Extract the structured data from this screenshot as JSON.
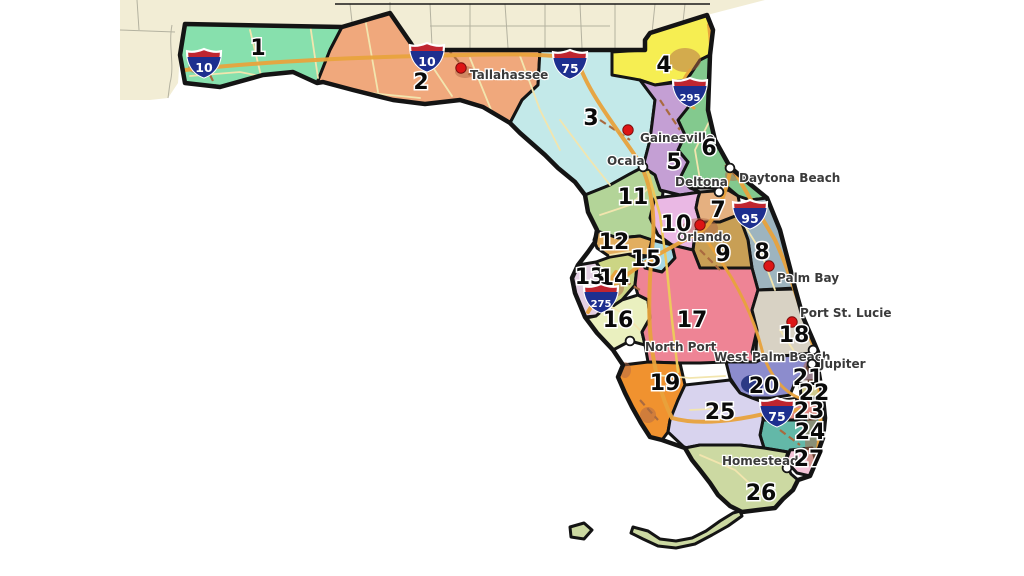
{
  "map": {
    "districts": [
      {
        "number": "1",
        "color": "#87e0ad",
        "label_x": 258,
        "label_y": 55
      },
      {
        "number": "2",
        "color": "#f0a87c",
        "label_x": 421,
        "label_y": 89
      },
      {
        "number": "3",
        "color": "#c3e9e9",
        "label_x": 591,
        "label_y": 125
      },
      {
        "number": "4",
        "color": "#f6ee52",
        "label_x": 664,
        "label_y": 72
      },
      {
        "number": "5",
        "color": "#c49fd4",
        "label_x": 674,
        "label_y": 169
      },
      {
        "number": "6",
        "color": "#83c98e",
        "label_x": 709,
        "label_y": 155
      },
      {
        "number": "7",
        "color": "#e5b080",
        "label_x": 718,
        "label_y": 217
      },
      {
        "number": "8",
        "color": "#9db4bf",
        "label_x": 762,
        "label_y": 259
      },
      {
        "number": "9",
        "color": "#c89f55",
        "label_x": 723,
        "label_y": 261
      },
      {
        "number": "10",
        "color": "#eab8e4",
        "label_x": 676,
        "label_y": 231
      },
      {
        "number": "11",
        "color": "#b3d498",
        "label_x": 633,
        "label_y": 204
      },
      {
        "number": "12",
        "color": "#e2ae5f",
        "label_x": 614,
        "label_y": 249
      },
      {
        "number": "13",
        "color": "#e3cfe3",
        "label_x": 590,
        "label_y": 284
      },
      {
        "number": "14",
        "color": "#ccd584",
        "label_x": 614,
        "label_y": 285
      },
      {
        "number": "15",
        "color": "#a7d8e3",
        "label_x": 646,
        "label_y": 266
      },
      {
        "number": "16",
        "color": "#eaf0bf",
        "label_x": 618,
        "label_y": 327
      },
      {
        "number": "17",
        "color": "#ee8495",
        "label_x": 692,
        "label_y": 327
      },
      {
        "number": "18",
        "color": "#d8d2c4",
        "label_x": 794,
        "label_y": 342
      },
      {
        "number": "19",
        "color": "#f0922f",
        "label_x": 665,
        "label_y": 390
      },
      {
        "number": "20",
        "color": "#8c8ccd",
        "label_x": 764,
        "label_y": 393
      },
      {
        "number": "21",
        "color": "#7f96d2",
        "label_x": 808,
        "label_y": 385
      },
      {
        "number": "22",
        "color": "#cfc98f",
        "label_x": 814,
        "label_y": 400
      },
      {
        "number": "23",
        "color": "#e28a84",
        "label_x": 809,
        "label_y": 418
      },
      {
        "number": "24",
        "color": "#63b8a8",
        "label_x": 810,
        "label_y": 439
      },
      {
        "number": "25",
        "color": "#d8d3ee",
        "label_x": 720,
        "label_y": 419
      },
      {
        "number": "26",
        "color": "#ccd9a2",
        "label_x": 761,
        "label_y": 500
      },
      {
        "number": "27",
        "color": "#f3c3d7",
        "label_x": 809,
        "label_y": 466
      }
    ],
    "cities": [
      {
        "name": "Tallahassee",
        "size": "large",
        "dot_x": 461,
        "dot_y": 68,
        "label_x": 470,
        "label_y": 79
      },
      {
        "name": "Gainesville",
        "size": "large",
        "dot_x": 628,
        "dot_y": 130,
        "label_x": 640,
        "label_y": 142
      },
      {
        "name": "Ocala",
        "size": "small",
        "dot_x": 643,
        "dot_y": 167,
        "label_x": 607,
        "label_y": 165
      },
      {
        "name": "Deltona",
        "size": "small",
        "dot_x": 719,
        "dot_y": 192,
        "label_x": 675,
        "label_y": 186
      },
      {
        "name": "Daytona Beach",
        "size": "small",
        "dot_x": 730,
        "dot_y": 168,
        "label_x": 739,
        "label_y": 182
      },
      {
        "name": "Orlando",
        "size": "large",
        "dot_x": 700,
        "dot_y": 225,
        "label_x": 677,
        "label_y": 241
      },
      {
        "name": "Palm Bay",
        "size": "large",
        "dot_x": 769,
        "dot_y": 266,
        "label_x": 777,
        "label_y": 282
      },
      {
        "name": "Port St. Lucie",
        "size": "large",
        "dot_x": 792,
        "dot_y": 322,
        "label_x": 800,
        "label_y": 317
      },
      {
        "name": "North Port",
        "size": "small",
        "dot_x": 630,
        "dot_y": 341,
        "label_x": 645,
        "label_y": 351
      },
      {
        "name": "West Palm Beach",
        "size": "small",
        "dot_x": 813,
        "dot_y": 350,
        "label_x": 714,
        "label_y": 361
      },
      {
        "name": "Jupiter",
        "size": "small",
        "dot_x": 812,
        "dot_y": 364,
        "label_x": 820,
        "label_y": 368
      },
      {
        "name": "Homestead",
        "size": "small",
        "dot_x": 787,
        "dot_y": 468,
        "label_x": 722,
        "label_y": 465
      }
    ],
    "interstate_shields": [
      {
        "route": "10",
        "x": 204,
        "y": 63
      },
      {
        "route": "10",
        "x": 427,
        "y": 57
      },
      {
        "route": "75",
        "x": 570,
        "y": 64
      },
      {
        "route": "295",
        "x": 690,
        "y": 92
      },
      {
        "route": "95",
        "x": 750,
        "y": 214
      },
      {
        "route": "275",
        "x": 601,
        "y": 298
      },
      {
        "route": "75",
        "x": 777,
        "y": 412
      }
    ],
    "colors": {
      "ocean": "#ffffff",
      "neighbor_land": "#f2edd5",
      "county_line": "#b4b2a0",
      "state_line": "#1a1a1a",
      "district_border": "#141414",
      "state_border": "#141414",
      "road_interstate": "#e8a33d",
      "road_highway": "#edc95c",
      "road_secondary": "#f2e5ae",
      "road_urban": "#a96a3f",
      "urban_area": "#b06848",
      "lake": "#2c3a85",
      "shield_red": "#bf2530",
      "shield_blue": "#1d2f8f",
      "shield_text": "#ffffff",
      "city_dot_large": "#dd1515",
      "city_dot_large_ring": "#7a0d0d",
      "city_dot_small": "#ffffff",
      "city_dot_small_ring": "#151515",
      "district_label": "#0a0a0a",
      "city_label": "#3a3a3a"
    }
  }
}
